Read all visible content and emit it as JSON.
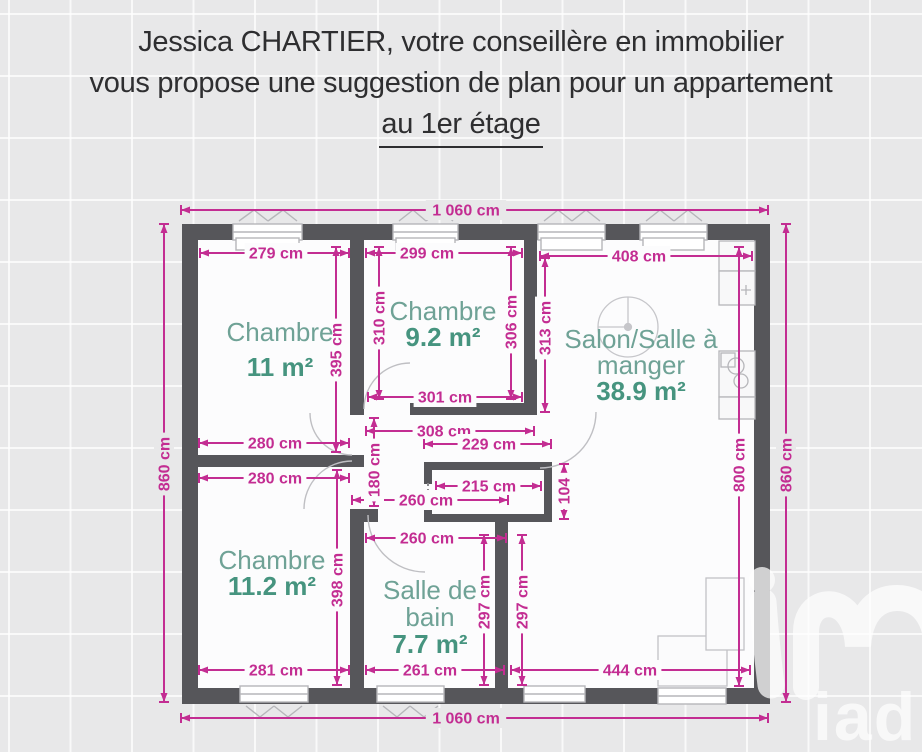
{
  "header": {
    "line1": "Jessica CHARTIER, votre conseillère en immobilier",
    "line2": "vous propose une suggestion de plan pour un appartement",
    "line3": "au 1er étage"
  },
  "watermark": {
    "text": "iad"
  },
  "colors": {
    "dimension": "#c32d92",
    "wall": "#56565a",
    "floor": "#fcfcfd",
    "page": "#e8e8e9",
    "room_name": "#6fa296",
    "room_area": "#46947f",
    "linework": "#b6b6ba"
  },
  "plan": {
    "unit": "cm",
    "rooms": [
      {
        "cx": 280,
        "name_lines": [
          "Chambre"
        ],
        "name_ys": [
          341
        ],
        "area": "11 m²",
        "area_y": 376
      },
      {
        "cx": 443,
        "name_lines": [
          "Chambre"
        ],
        "name_ys": [
          320
        ],
        "area": "9.2 m²",
        "area_y": 346
      },
      {
        "cx": 641,
        "name_lines": [
          "Salon/Salle à",
          "manger"
        ],
        "name_ys": [
          348,
          374
        ],
        "area": "38.9 m²",
        "area_y": 400
      },
      {
        "cx": 272,
        "name_lines": [
          "Chambre"
        ],
        "name_ys": [
          569
        ],
        "area": "11.2 m²",
        "area_y": 595
      },
      {
        "cx": 430,
        "name_lines": [
          "Salle de",
          "bain"
        ],
        "name_ys": [
          599,
          626
        ],
        "area": "7.7 m²",
        "area_y": 653
      }
    ],
    "dimensions": [
      {
        "label": "1 060 cm",
        "dir": "h",
        "at": 210,
        "from": 181,
        "to": 768,
        "cx": 466,
        "cy": 210,
        "bg": "page"
      },
      {
        "label": "279 cm",
        "dir": "h",
        "at": 253,
        "from": 200,
        "to": 349,
        "cx": 276,
        "cy": 253,
        "bg": "floor"
      },
      {
        "label": "299 cm",
        "dir": "h",
        "at": 253,
        "from": 366,
        "to": 522,
        "cx": 427,
        "cy": 253,
        "bg": "floor"
      },
      {
        "label": "408 cm",
        "dir": "h",
        "at": 256,
        "from": 540,
        "to": 752,
        "cx": 639,
        "cy": 256,
        "bg": "floor"
      },
      {
        "label": "301 cm",
        "dir": "h",
        "at": 397,
        "from": 368,
        "to": 522,
        "cx": 445,
        "cy": 397,
        "bg": "floor"
      },
      {
        "label": "280 cm",
        "dir": "h",
        "at": 443,
        "from": 199,
        "to": 349,
        "cx": 275,
        "cy": 443,
        "bg": "floor"
      },
      {
        "label": "308 cm",
        "dir": "h",
        "at": 431,
        "from": 366,
        "to": 534,
        "cx": 444,
        "cy": 431,
        "bg": "floor"
      },
      {
        "label": "229 cm",
        "dir": "h",
        "at": 444,
        "from": 424,
        "to": 551,
        "cx": 489,
        "cy": 444,
        "bg": "floor"
      },
      {
        "label": "280 cm",
        "dir": "h",
        "at": 478,
        "from": 199,
        "to": 349,
        "cx": 275,
        "cy": 478,
        "bg": "floor"
      },
      {
        "label": "215 cm",
        "dir": "h",
        "at": 486,
        "from": 436,
        "to": 541,
        "cx": 489,
        "cy": 486,
        "bg": "floor"
      },
      {
        "label": "260 cm",
        "dir": "h",
        "at": 500,
        "from": 352,
        "to": 508,
        "cx": 426,
        "cy": 500,
        "bg": "floor"
      },
      {
        "label": "260 cm",
        "dir": "h",
        "at": 538,
        "from": 366,
        "to": 506,
        "cx": 427,
        "cy": 538,
        "bg": "floor"
      },
      {
        "label": "281 cm",
        "dir": "h",
        "at": 670,
        "from": 199,
        "to": 349,
        "cx": 276,
        "cy": 670,
        "bg": "floor"
      },
      {
        "label": "261 cm",
        "dir": "h",
        "at": 670,
        "from": 366,
        "to": 504,
        "cx": 430,
        "cy": 670,
        "bg": "floor"
      },
      {
        "label": "444 cm",
        "dir": "h",
        "at": 670,
        "from": 511,
        "to": 750,
        "cx": 630,
        "cy": 670,
        "bg": "floor"
      },
      {
        "label": "1 060 cm",
        "dir": "h",
        "at": 718,
        "from": 181,
        "to": 768,
        "cx": 466,
        "cy": 718,
        "bg": "page"
      },
      {
        "label": "860 cm",
        "dir": "v",
        "at": 164,
        "from": 224,
        "to": 702,
        "cx": 164,
        "cy": 464,
        "bg": "page"
      },
      {
        "label": "395 cm",
        "dir": "v",
        "at": 336,
        "from": 247,
        "to": 452,
        "cx": 336,
        "cy": 350,
        "bg": "floor"
      },
      {
        "label": "310 cm",
        "dir": "v",
        "at": 379,
        "from": 247,
        "to": 399,
        "cx": 379,
        "cy": 318,
        "bg": "floor"
      },
      {
        "label": "306 cm",
        "dir": "v",
        "at": 511,
        "from": 247,
        "to": 399,
        "cx": 511,
        "cy": 322,
        "bg": "floor"
      },
      {
        "label": "313 cm",
        "dir": "v",
        "at": 545,
        "from": 258,
        "to": 412,
        "cx": 545,
        "cy": 328,
        "bg": "floor"
      },
      {
        "label": "180 cm",
        "dir": "v",
        "at": 374,
        "from": 418,
        "to": 506,
        "cx": 374,
        "cy": 470,
        "bg": "floor"
      },
      {
        "label": "104",
        "dir": "v",
        "at": 564,
        "from": 464,
        "to": 519,
        "cx": 564,
        "cy": 491,
        "bg": "floor"
      },
      {
        "label": "398 cm",
        "dir": "v",
        "at": 337,
        "from": 470,
        "to": 685,
        "cx": 337,
        "cy": 580,
        "bg": "floor"
      },
      {
        "label": "297 cm",
        "dir": "v",
        "at": 484,
        "from": 535,
        "to": 685,
        "cx": 484,
        "cy": 602,
        "bg": "floor"
      },
      {
        "label": "297 cm",
        "dir": "v",
        "at": 522,
        "from": 535,
        "to": 685,
        "cx": 522,
        "cy": 602,
        "bg": "floor"
      },
      {
        "label": "800 cm",
        "dir": "v",
        "at": 739,
        "from": 247,
        "to": 686,
        "cx": 739,
        "cy": 465,
        "bg": "floor"
      },
      {
        "label": "860 cm",
        "dir": "v",
        "at": 786,
        "from": 224,
        "to": 702,
        "cx": 786,
        "cy": 465,
        "bg": "page"
      }
    ]
  }
}
